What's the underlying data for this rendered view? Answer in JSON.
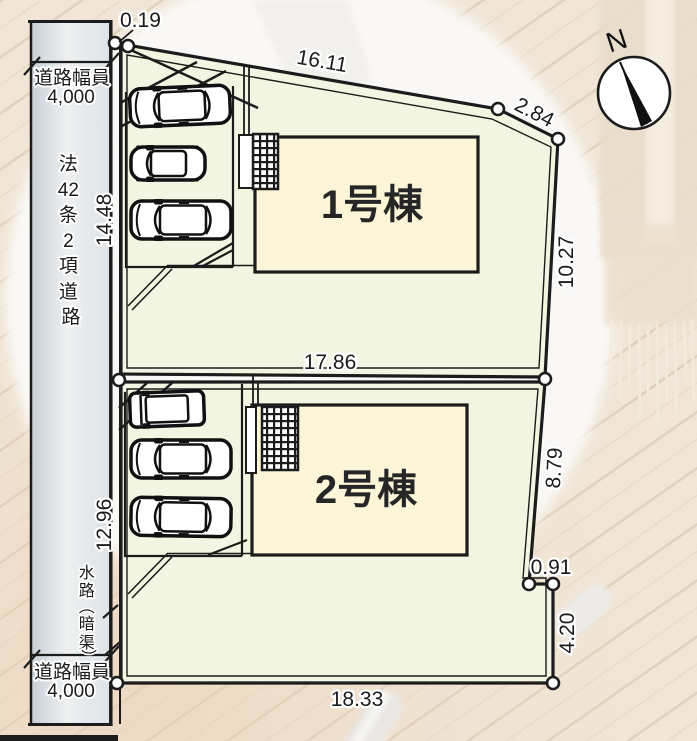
{
  "plan": {
    "title": "site-plan",
    "north_label": "N",
    "buildings": [
      {
        "label": "1号棟"
      },
      {
        "label": "2号棟"
      }
    ],
    "road": {
      "name_vertical": [
        "法",
        "42",
        "条",
        "2",
        "項",
        "道",
        "路"
      ],
      "width_label": "道路幅員",
      "width_value": "4,000",
      "waterway_vertical": [
        "水",
        "路",
        "︵",
        "暗",
        "渠",
        "︶"
      ]
    },
    "dimensions": {
      "offset_top": "0.19",
      "top_edge": "16.11",
      "top_right_edge": "2.84",
      "west_lot1": "14.48",
      "east_lot1": "10.27",
      "middle_boundary": "17.86",
      "west_lot2": "12.96",
      "east_lot2": "8.79",
      "step_east": "0.91",
      "east_lower": "4.20",
      "bottom_edge": "18.33"
    },
    "colors": {
      "parcel_fill": "#f1f5e1",
      "building_fill": "#fdf5d8",
      "road_fill": "#dfe5e9",
      "line": "#1c1c1c",
      "floor": "#efe5d6"
    }
  }
}
